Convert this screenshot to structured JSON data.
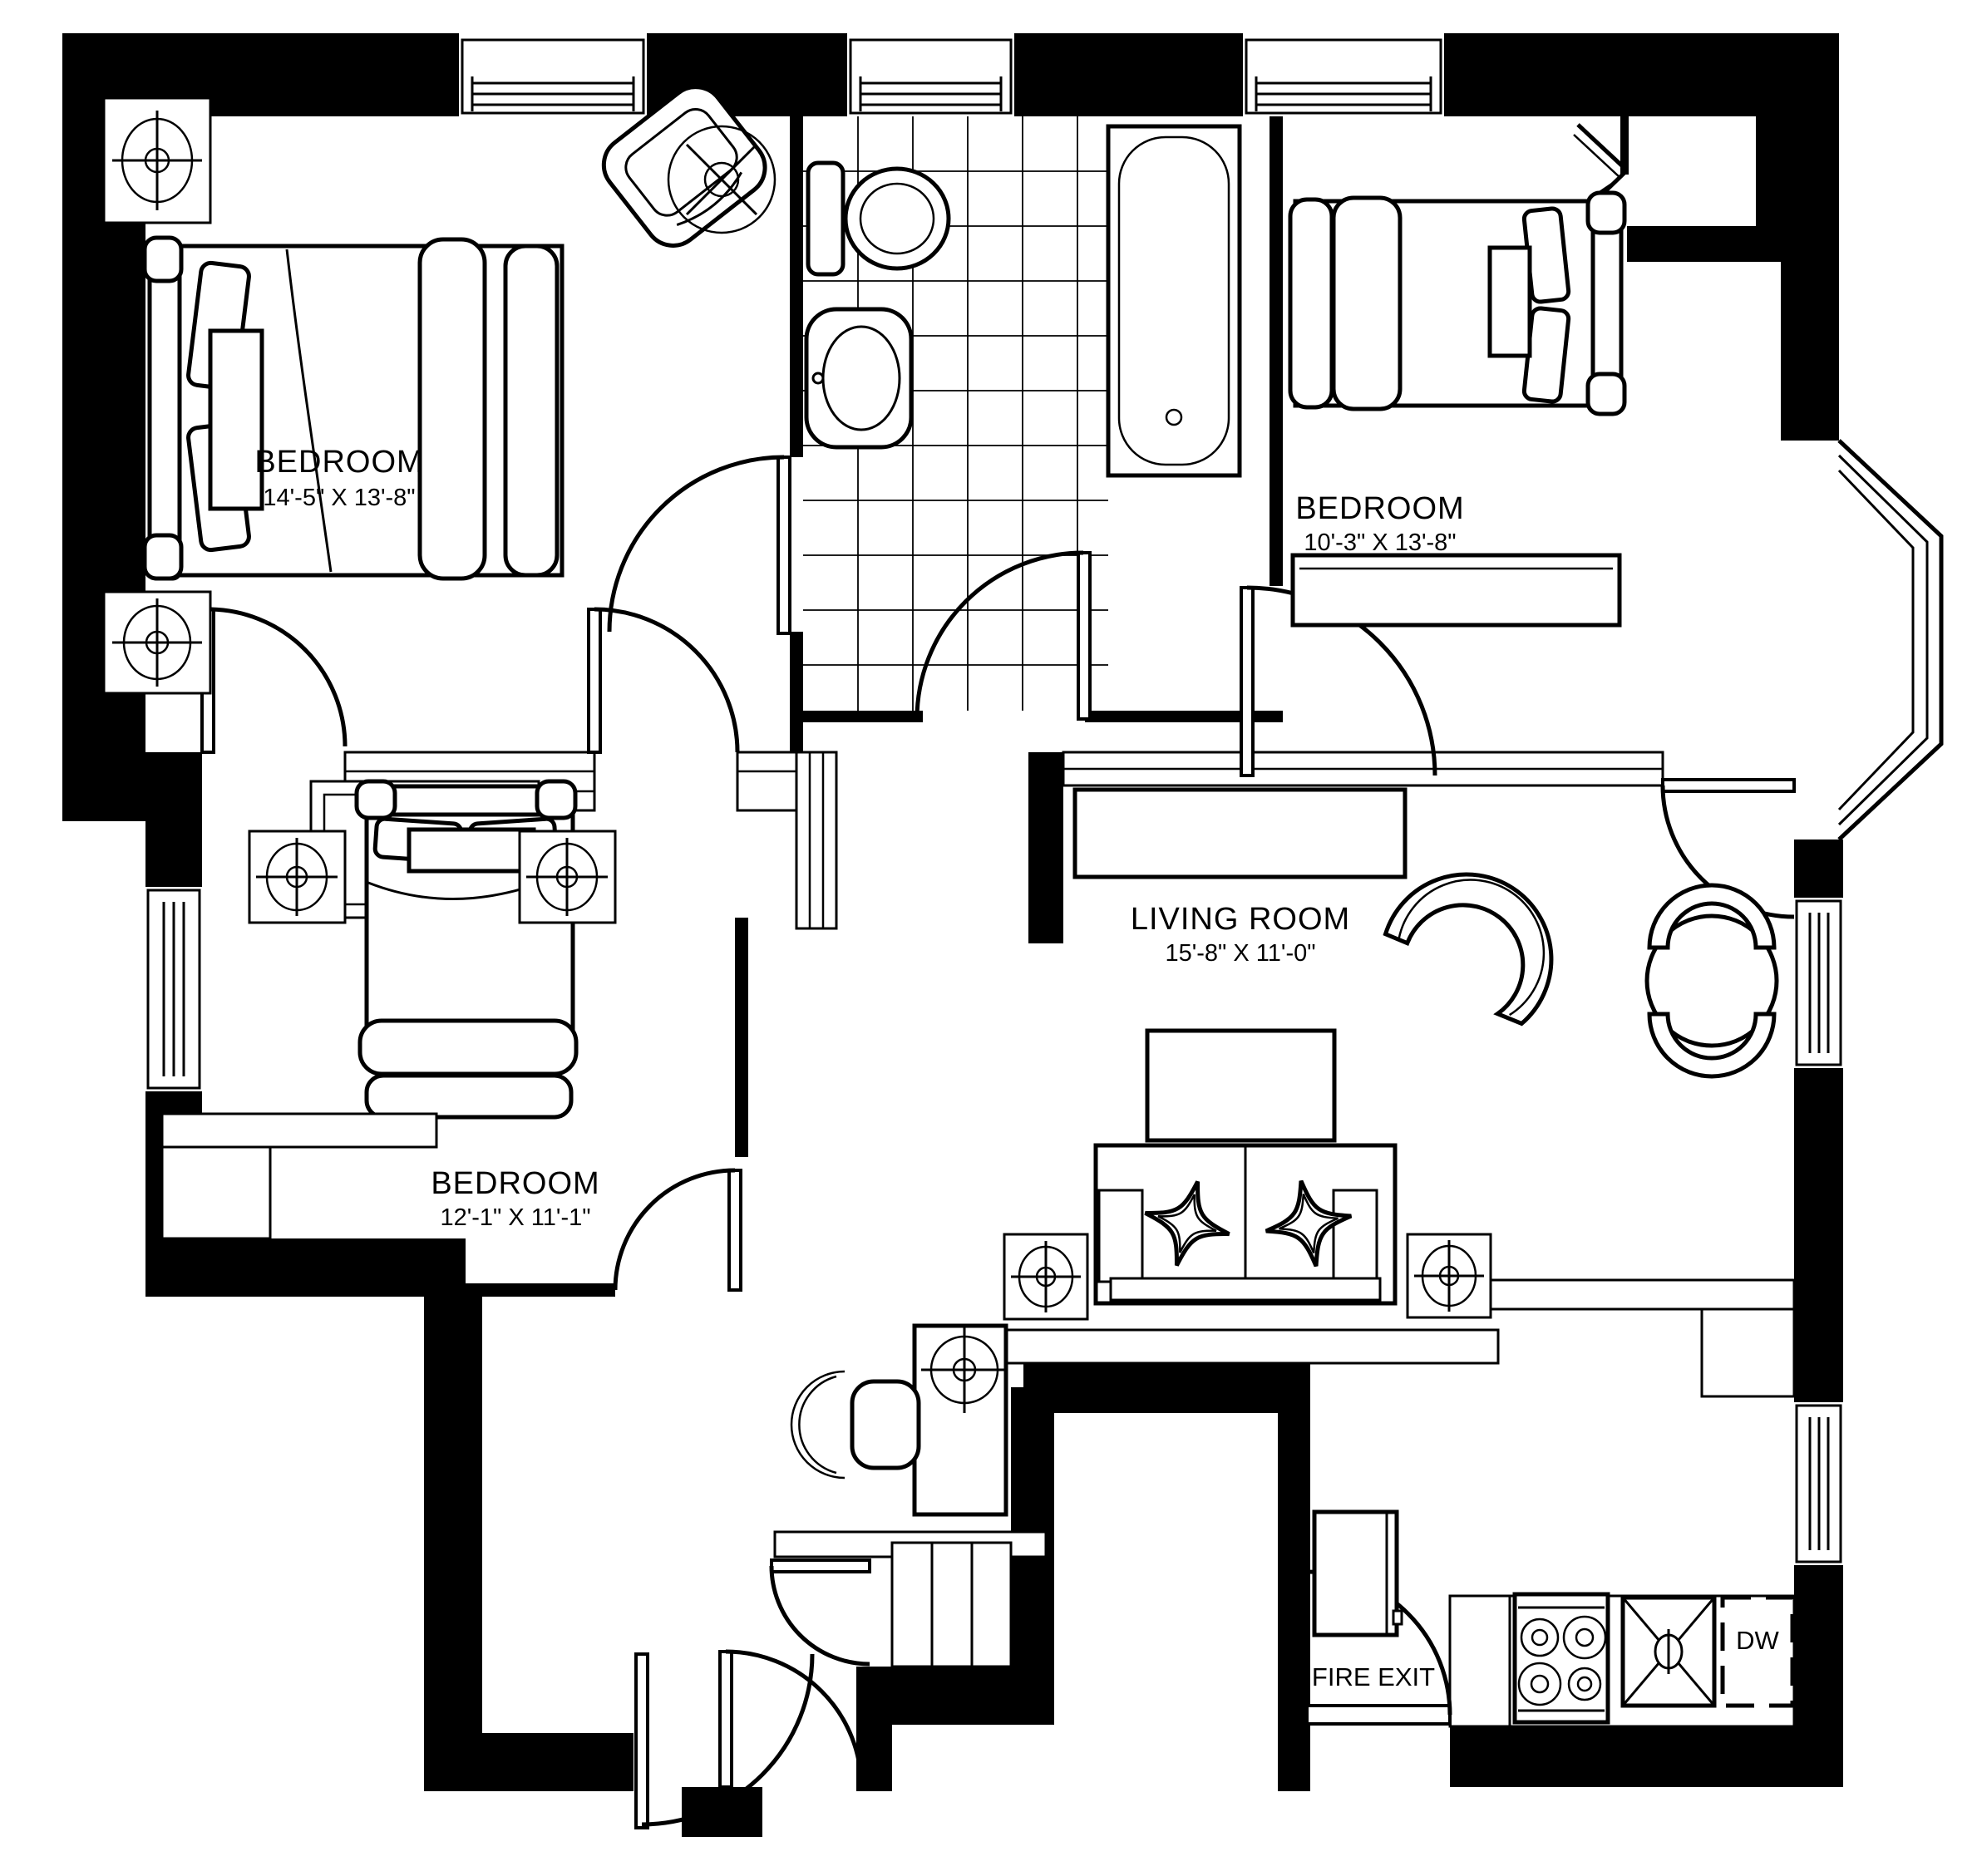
{
  "plan": {
    "type": "apartment-floor-plan",
    "rooms": [
      {
        "name": "BEDROOM",
        "dims": "14'-5\" X 13'-8\""
      },
      {
        "name": "BEDROOM",
        "dims": "10'-3\" X 13'-8\""
      },
      {
        "name": "BEDROOM",
        "dims": "12'-1\" X 11'-1\""
      },
      {
        "name": "LIVING ROOM",
        "dims": "15'-8\" X 11'-0\""
      }
    ],
    "labels": {
      "fire_exit": "FIRE EXIT",
      "dishwasher": "DW"
    },
    "fixtures": [
      "bed",
      "bed",
      "bed",
      "armchair",
      "sofa",
      "coffee-table",
      "tv-console",
      "fan-chair",
      "dining-table",
      "dining-chairs",
      "desk",
      "desk-chair",
      "toilet",
      "pedestal-sink",
      "bathtub",
      "stove",
      "kitchen-sink",
      "dishwasher",
      "fridge",
      "stairs",
      "ceiling-lights",
      "bay-window",
      "closet",
      "dresser"
    ],
    "colors": {
      "wall": "#000000",
      "background": "#ffffff",
      "line": "#000000"
    }
  }
}
